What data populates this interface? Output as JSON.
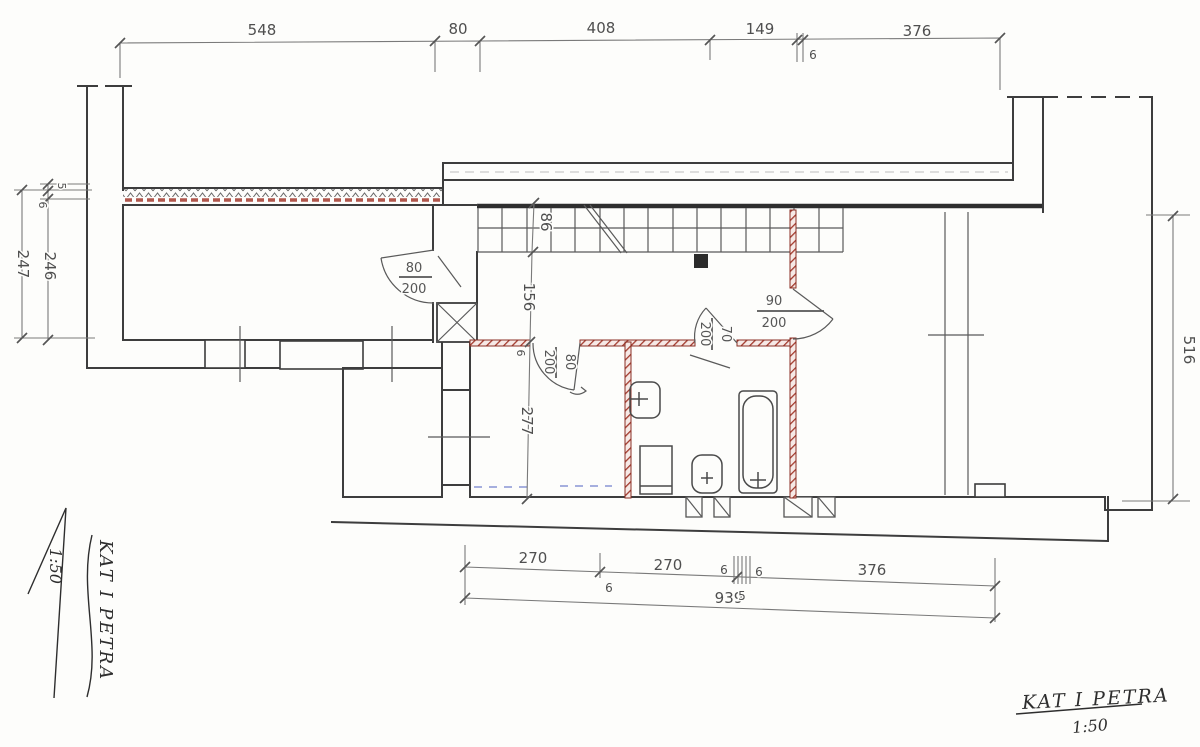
{
  "dimensions": {
    "top": [
      "548",
      "80",
      "408",
      "149",
      "376",
      "6"
    ],
    "bottom": [
      "270",
      "270",
      "376",
      "939",
      "6",
      "6",
      "6",
      "5"
    ],
    "left": [
      "247",
      "246",
      "5",
      "6"
    ],
    "right": [
      "516"
    ],
    "interior": [
      "86",
      "156",
      "277",
      "6"
    ]
  },
  "doors": {
    "entry": {
      "w": "80",
      "h": "200"
    },
    "hall": {
      "w": "80",
      "h": "200"
    },
    "bath": {
      "w": "70",
      "h": "200"
    },
    "living": {
      "w": "90",
      "h": "200"
    }
  },
  "notes": {
    "corner": {
      "title": "KAT I PETRA",
      "scale": "1:50"
    },
    "margin": {
      "title": "KAT I PETRA",
      "scale": "1:50"
    }
  },
  "colors": {
    "paper": "#fdfdfb",
    "ink": "#3d3d3d",
    "new_wall_red": "#a33b2e",
    "mark_blue": "#4a5fc0"
  }
}
